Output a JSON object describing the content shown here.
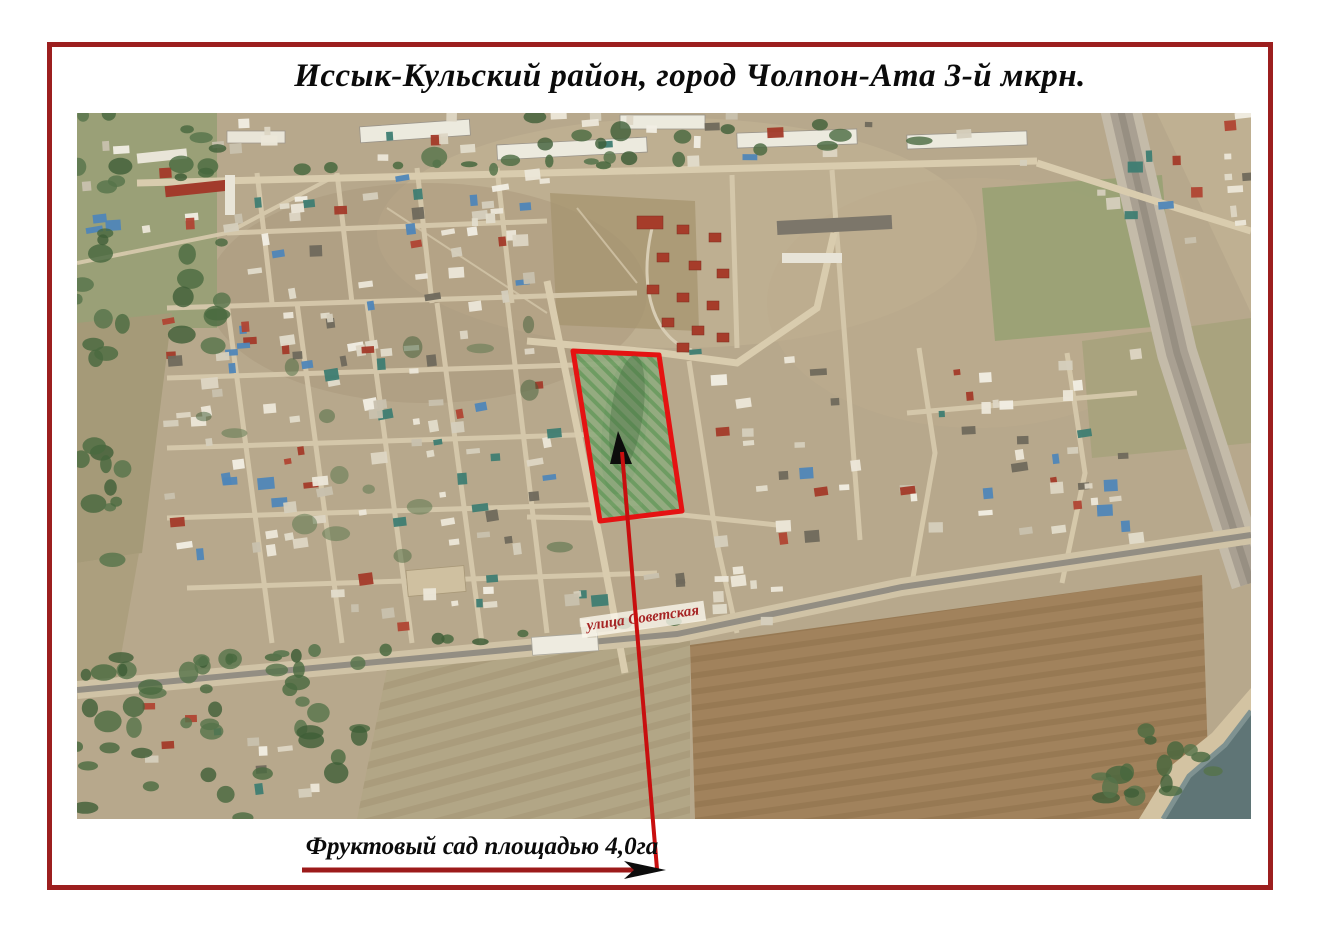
{
  "title": "Иссык-Кульский район, город Чолпон-Ата 3-й мкрн.",
  "map": {
    "street_label": "улица Советская",
    "caption": "Фруктовый сад площадью 4,0га"
  },
  "colors": {
    "frame_red": "#9c1f1f",
    "annotation_red": "#c80f0f",
    "plot_outline_red": "#e51212",
    "street_label_red": "#a62424",
    "orchard_green": "#6f9c63",
    "terrain_tan": "#b7a88c",
    "lake_teal": "#5f7576"
  }
}
